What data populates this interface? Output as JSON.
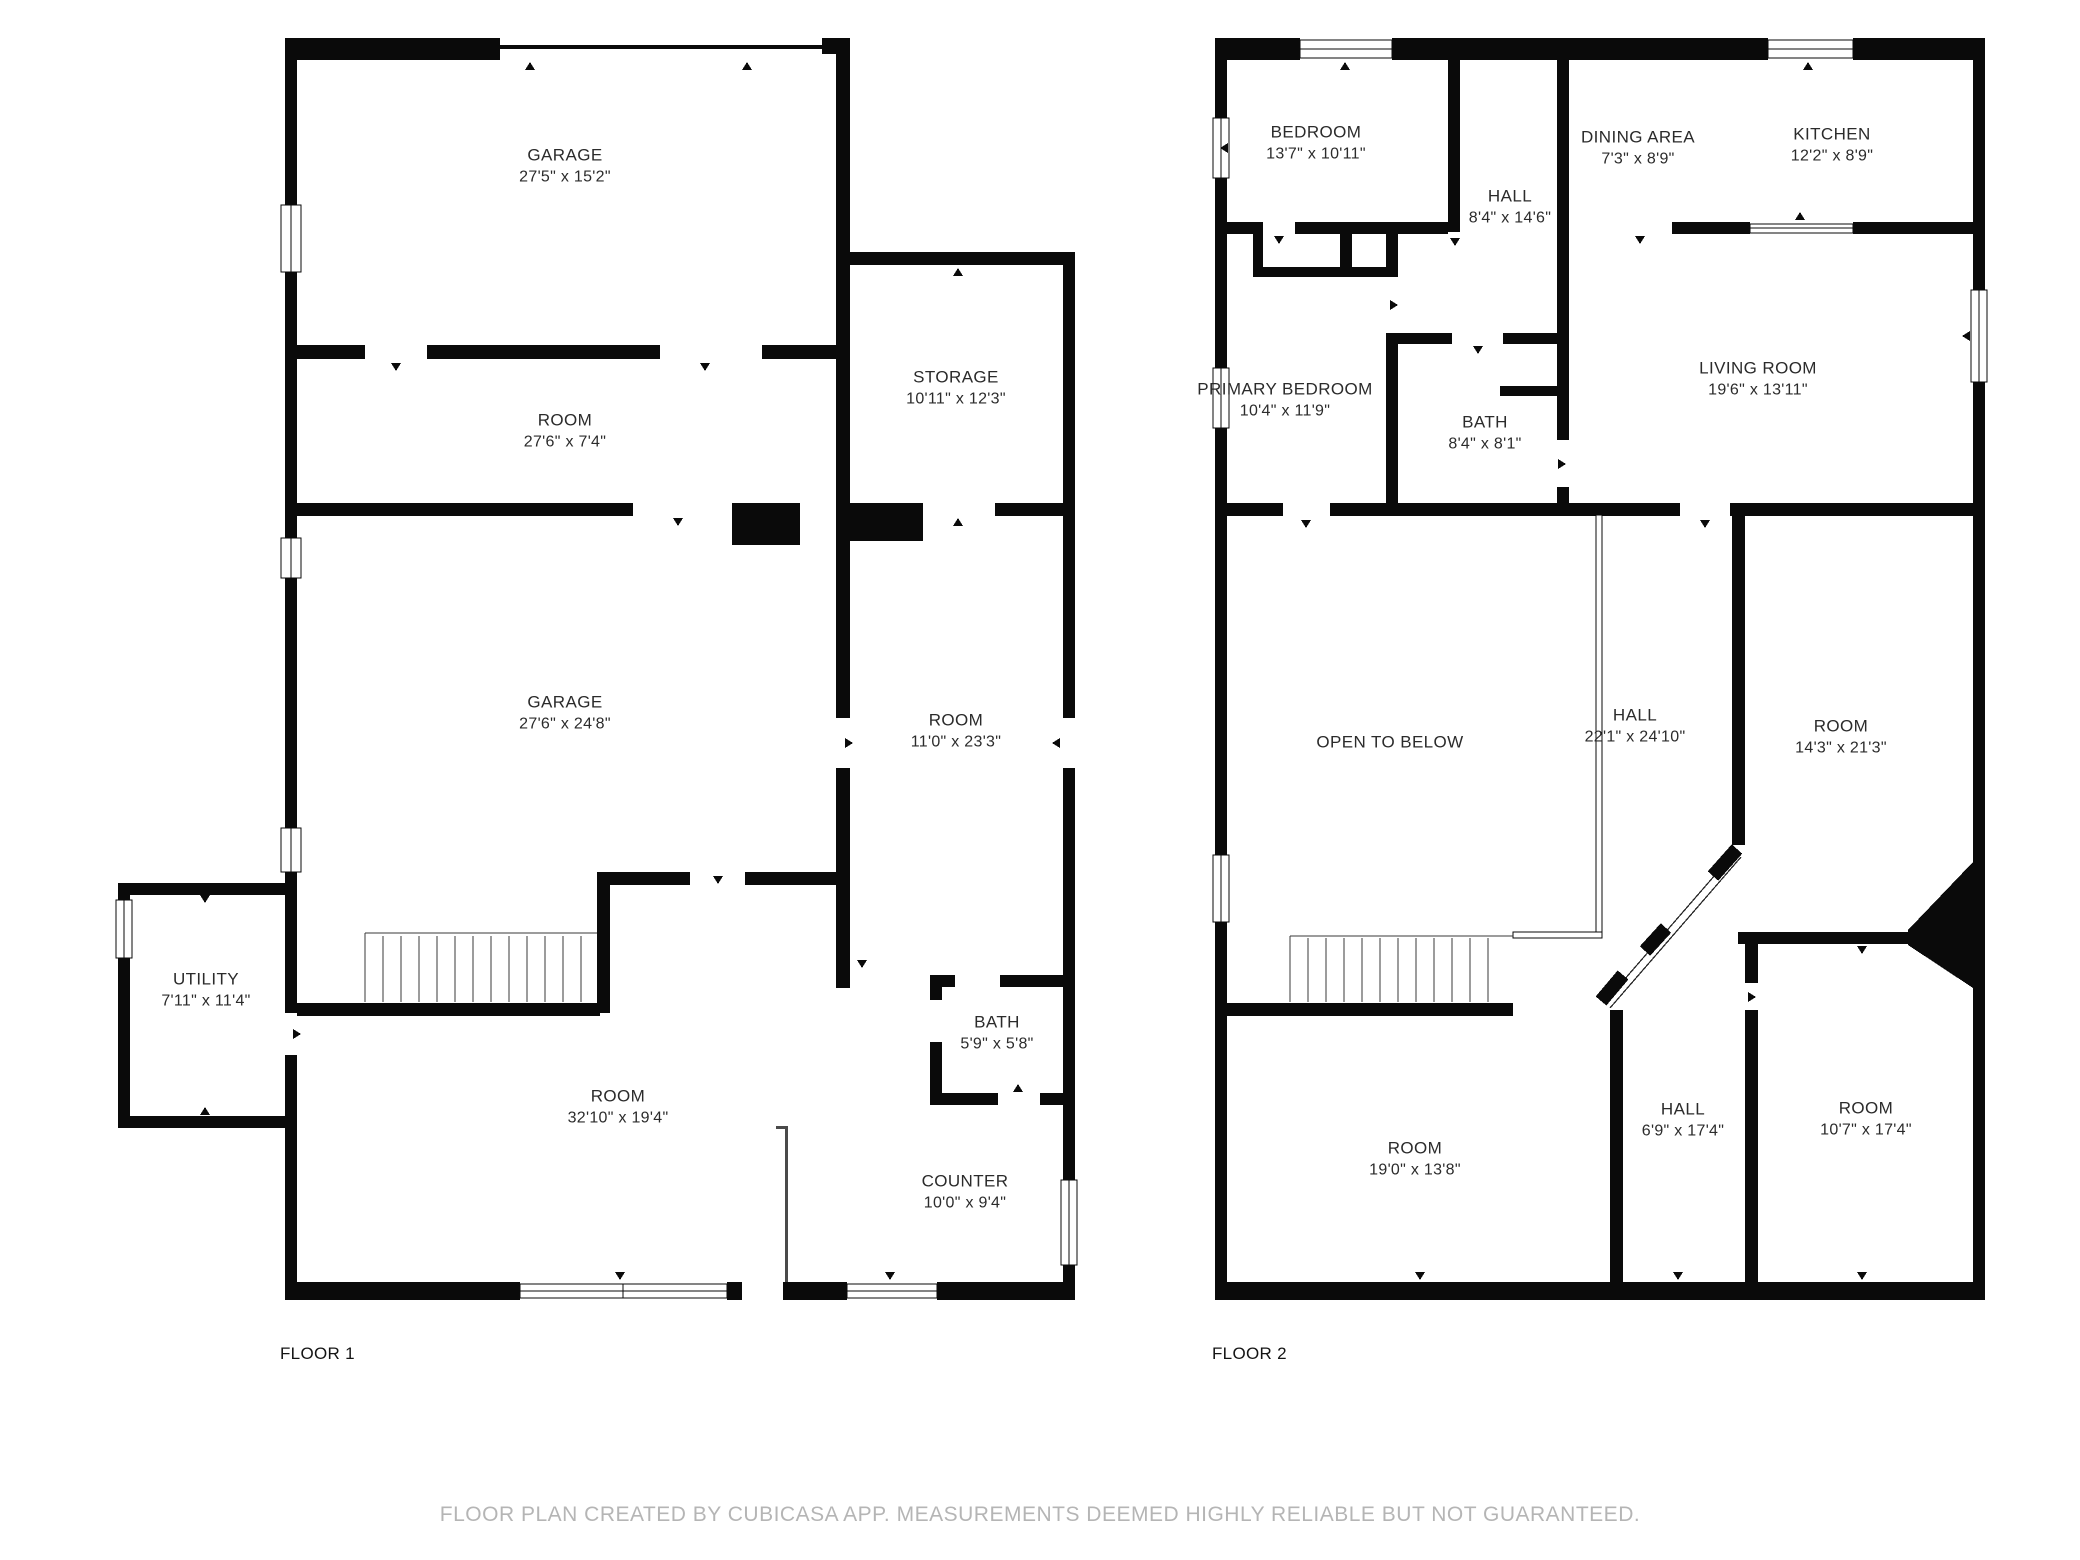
{
  "disclaimer": "FLOOR PLAN CREATED BY CUBICASA APP. MEASUREMENTS DEEMED HIGHLY RELIABLE BUT NOT GUARANTEED.",
  "colors": {
    "wall": "#0a0a0a",
    "background": "#ffffff",
    "label_text": "#2b2b2b",
    "disclaimer_text": "#b5b5b5"
  },
  "floors": [
    {
      "label": "FLOOR 1",
      "rooms": [
        {
          "name": "GARAGE",
          "dims": "27'5\" x 15'2\""
        },
        {
          "name": "ROOM",
          "dims": "27'6\" x 7'4\""
        },
        {
          "name": "STORAGE",
          "dims": "10'11\" x 12'3\""
        },
        {
          "name": "GARAGE",
          "dims": "27'6\" x 24'8\""
        },
        {
          "name": "ROOM",
          "dims": "11'0\" x 23'3\""
        },
        {
          "name": "UTILITY",
          "dims": "7'11\" x 11'4\""
        },
        {
          "name": "ROOM",
          "dims": "32'10\" x 19'4\""
        },
        {
          "name": "BATH",
          "dims": "5'9\" x 5'8\""
        },
        {
          "name": "COUNTER",
          "dims": "10'0\" x 9'4\""
        }
      ]
    },
    {
      "label": "FLOOR 2",
      "rooms": [
        {
          "name": "BEDROOM",
          "dims": "13'7\" x 10'11\""
        },
        {
          "name": "HALL",
          "dims": "8'4\" x 14'6\""
        },
        {
          "name": "DINING AREA",
          "dims": "7'3\" x 8'9\""
        },
        {
          "name": "KITCHEN",
          "dims": "12'2\" x 8'9\""
        },
        {
          "name": "PRIMARY BEDROOM",
          "dims": "10'4\" x 11'9\""
        },
        {
          "name": "BATH",
          "dims": "8'4\" x 8'1\""
        },
        {
          "name": "LIVING ROOM",
          "dims": "19'6\" x 13'11\""
        },
        {
          "name": "OPEN TO BELOW",
          "dims": ""
        },
        {
          "name": "HALL",
          "dims": "22'1\" x 24'10\""
        },
        {
          "name": "ROOM",
          "dims": "14'3\" x 21'3\""
        },
        {
          "name": "ROOM",
          "dims": "19'0\" x 13'8\""
        },
        {
          "name": "HALL",
          "dims": "6'9\" x 17'4\""
        },
        {
          "name": "ROOM",
          "dims": "10'7\" x 17'4\""
        }
      ]
    }
  ]
}
